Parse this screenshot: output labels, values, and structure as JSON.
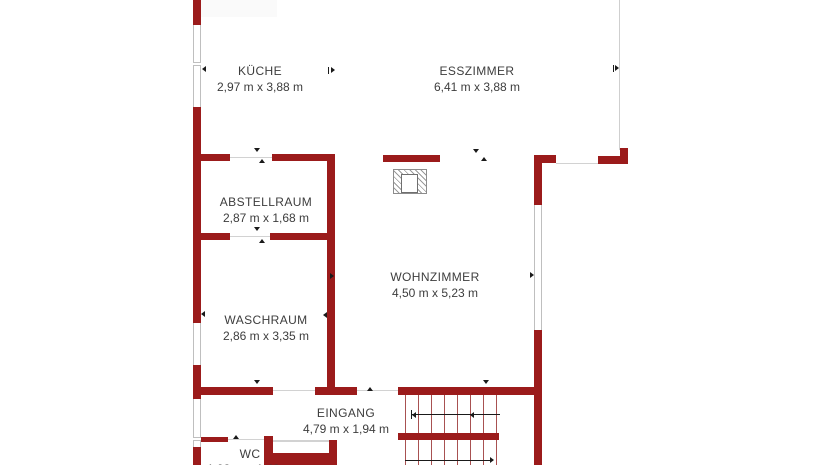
{
  "plan_title": "floor-plan",
  "palette": {
    "wall": "#9b1b1b",
    "stair_line": "#a85151",
    "outline": "#bfbfbf",
    "text": "#3d3d3d",
    "background": "#ffffff"
  },
  "rooms": [
    {
      "id": "kueche",
      "name": "KÜCHE",
      "dims": "2,97 m x 3,88 m"
    },
    {
      "id": "esszimmer",
      "name": "ESSZIMMER",
      "dims": "6,41 m x 3,88 m"
    },
    {
      "id": "abstellraum",
      "name": "ABSTELLRAUM",
      "dims": "2,87 m x 1,68 m"
    },
    {
      "id": "wohnzimmer",
      "name": "WOHNZIMMER",
      "dims": "4,50 m x 5,23 m"
    },
    {
      "id": "waschraum",
      "name": "WASCHRAUM",
      "dims": "2,86 m x 3,35 m"
    },
    {
      "id": "eingang",
      "name": "EINGANG",
      "dims": "4,79 m x 1,94 m"
    },
    {
      "id": "wc",
      "name": "WC",
      "dims": "1,93 m x 1,43 m"
    }
  ],
  "symbols": {
    "chimney": "hatched-chimney-block",
    "stairs": "double-flight-staircase-with-direction-arrows",
    "door_markers": "small-black-arrow-ticks",
    "windows": "white-inset-with-gray-frame"
  }
}
